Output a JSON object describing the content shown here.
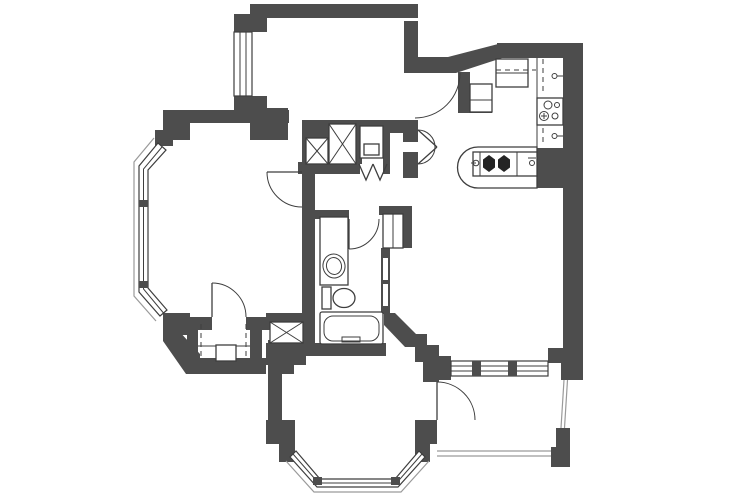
{
  "document": {
    "kind": "apartment floor plan drawing",
    "style": "monochrome scanned blueprint, no text labels visible"
  },
  "colors": {
    "background": "#ffffff",
    "wall_fill": "#4d4d4d",
    "line": "#3e3e3e",
    "sill": "#9a9a9a",
    "fixture_fill": "#ffffff",
    "burner_fill": "#242424"
  },
  "elements": {
    "windows": [
      "top-bedroom-window",
      "living-room-bay-window",
      "bottom-bedroom-bay-window",
      "balcony-window-wall"
    ],
    "doors": [
      "top-bedroom-door",
      "foyer-entry-door",
      "living-room-upper-door",
      "bathroom-door",
      "living-room-lower-door",
      "balcony-door",
      "utility-bifold-doors"
    ],
    "shafts": [
      "x-shaft-left",
      "x-shaft-right",
      "x-shaft-lower"
    ],
    "kitchen_fixtures": [
      "refrigerator",
      "corner-cabinet",
      "upper-cabinets-dashed",
      "double-sink",
      "wall-faucet-upper",
      "wall-faucet-lower",
      "cooktop-island",
      "burner-left",
      "burner-right",
      "island-faucet-left",
      "island-faucet-right"
    ],
    "bathroom_fixtures": [
      "vanity-counter",
      "vanity-sink",
      "toilet",
      "bathtub",
      "linen-cabinet",
      "wall-niches"
    ],
    "other": [
      "fireplace",
      "utility-closet",
      "balcony-railing"
    ]
  }
}
